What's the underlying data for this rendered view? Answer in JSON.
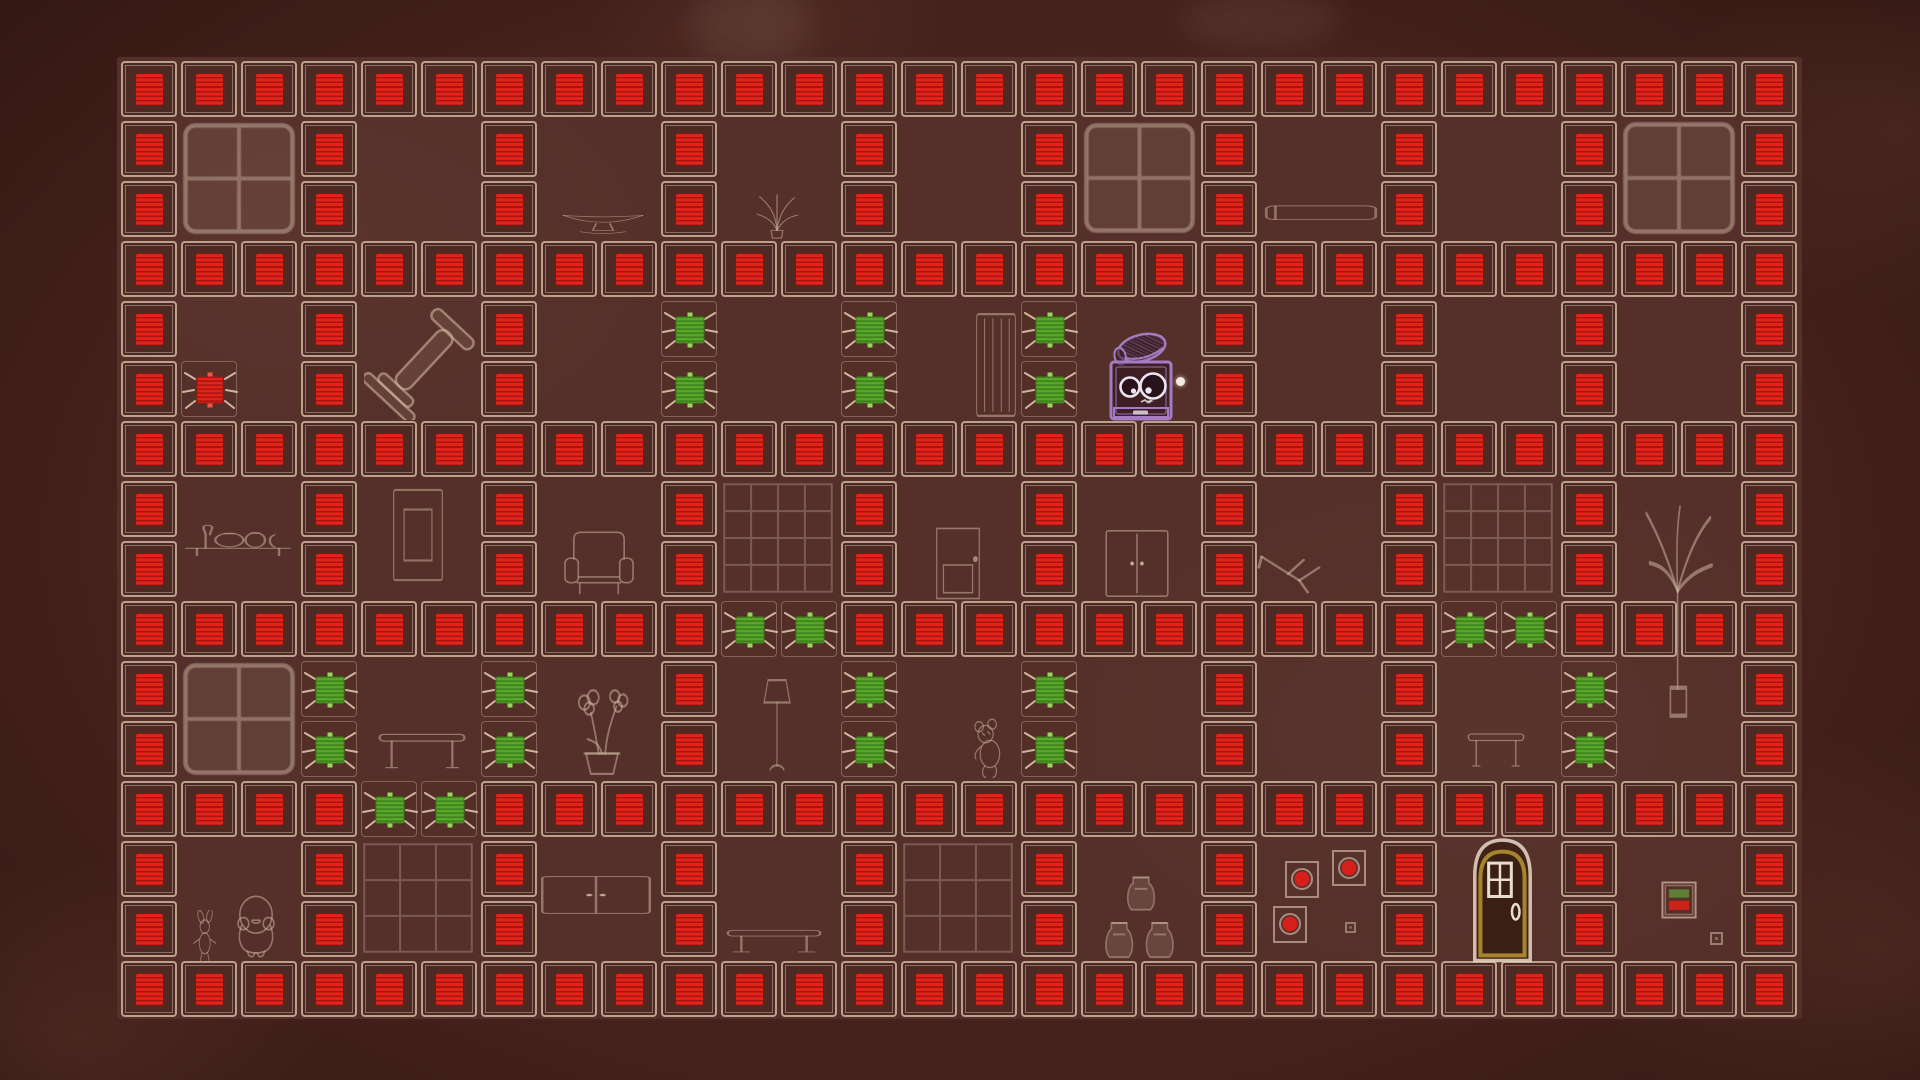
{
  "screen": {
    "type": "puzzle-game-level",
    "visible_text": "",
    "hud": "none"
  },
  "colors": {
    "background": "#45221c",
    "field": "#55302a",
    "tile_outline": "#d9c3ab",
    "wall_fill": "#4c2a23",
    "red_block": "#e2231a",
    "red_block_stripe": "#a81410",
    "gem_green": "#58a827",
    "gem_green_stripe": "#3c7d1a",
    "gem_notch": "#97d55f",
    "whisker": "#dcc5ab",
    "sketch_line": "#cbb39d",
    "player_purple": "#a57cc4",
    "eye_white": "#ece4f0",
    "exit_door_gold": "#a5842e",
    "picture_dot_red": "#d61f1a",
    "cursor_dot": "#f3ece4"
  },
  "level": {
    "cols": 28,
    "rows": 16,
    "cell_px": 60,
    "tile_px": 56,
    "origin_x": 121,
    "origin_y": 61,
    "legend": {
      "W": "red-wall-block",
      "G": "green-gem",
      "R": "red-gem",
      "P": "player",
      ".": "floor"
    },
    "counts": {
      "red_wall_blocks": 246,
      "green_gems": 22,
      "red_gems": 1
    },
    "map": [
      "WWWWWWWWWWWWWWWWWWWWWWWWWWWW",
      "W..W..W..W..W..W..W..W..W..W",
      "W..W..W..W..W..W..W..W..W..W",
      "WWWWWWWWWWWWWWWWWWWWWWWWWWWW",
      "W..W..W..G..G..G..W..W..W..W",
      "WR.W..W..G..G..G.PW..W..W..W",
      "WWWWWWWWWWWWWWWWWWWWWWWWWWWW",
      "W..W..W..W..W..W..W..W..W..W",
      "W..W..W..W..W..W..W..W..W..W",
      "WWWWWWWWWWGGWWWWWWWWWWGGWWWW",
      "W..G..G..W..G..G..W..W..G..W",
      "W..G..G..W..G..G..W..W..G..W",
      "WWWWGGWWWWWWWWWWWWWWWWWWWWWW",
      "W..W..W..W..W..W..W..W..W..W",
      "W..W..W..W..W..W..W..W..W..W",
      "WWWWWWWWWWWWWWWWWWWWWWWWWWWW"
    ]
  },
  "player": {
    "name": "robot",
    "col": 16.5,
    "row": 5,
    "x": 1108,
    "y": 330,
    "w": 66,
    "h": 92,
    "wearing": "knit-cap",
    "dot": {
      "x": 1180,
      "y": 381,
      "r": 4.5
    }
  },
  "furniture": [
    {
      "type": "window",
      "name": "window-sketch",
      "x": 182,
      "y": 122,
      "w": 114,
      "h": 113
    },
    {
      "type": "window",
      "name": "window-sketch",
      "x": 1083,
      "y": 122,
      "w": 113,
      "h": 112
    },
    {
      "type": "window",
      "name": "window-sketch",
      "x": 1622,
      "y": 121,
      "w": 114,
      "h": 114
    },
    {
      "type": "window",
      "name": "light-rug-sketch",
      "x": 182,
      "y": 662,
      "w": 114,
      "h": 114
    },
    {
      "type": "rug4",
      "name": "grid-rug-sketch",
      "x": 722,
      "y": 482,
      "w": 112,
      "h": 112
    },
    {
      "type": "rug4",
      "name": "grid-rug-sketch",
      "x": 1442,
      "y": 482,
      "w": 112,
      "h": 112
    },
    {
      "type": "rug3",
      "name": "grid-rug-sketch",
      "x": 362,
      "y": 842,
      "w": 112,
      "h": 112
    },
    {
      "type": "rug3",
      "name": "grid-rug-sketch",
      "x": 902,
      "y": 842,
      "w": 112,
      "h": 112
    },
    {
      "type": "bowl",
      "name": "bowl-sketch",
      "x": 560,
      "y": 208,
      "w": 86,
      "h": 34
    },
    {
      "type": "agave",
      "name": "spiky-plant-sketch",
      "x": 748,
      "y": 192,
      "w": 58,
      "h": 48
    },
    {
      "type": "sideboard",
      "name": "sideboard-sketch",
      "x": 1264,
      "y": 196,
      "w": 114,
      "h": 38
    },
    {
      "type": "dumbbell",
      "name": "dumbbell-sketch",
      "x": 364,
      "y": 306,
      "w": 114,
      "h": 114
    },
    {
      "type": "slatdoor",
      "name": "slatted-door-sketch",
      "x": 974,
      "y": 312,
      "w": 44,
      "h": 106
    },
    {
      "type": "shelfbottles",
      "name": "shelf-bottles-sketch",
      "x": 184,
      "y": 514,
      "w": 108,
      "h": 52
    },
    {
      "type": "frame2",
      "name": "picture-frame-sketch",
      "x": 389,
      "y": 486,
      "w": 58,
      "h": 98
    },
    {
      "type": "armchair",
      "name": "armchair-sketch",
      "x": 562,
      "y": 528,
      "w": 74,
      "h": 72
    },
    {
      "type": "door1",
      "name": "door-sketch",
      "x": 930,
      "y": 527,
      "w": 56,
      "h": 73
    },
    {
      "type": "wardrobe",
      "name": "wardrobe-sketch",
      "x": 1102,
      "y": 528,
      "w": 70,
      "h": 71
    },
    {
      "type": "chairfallen",
      "name": "tipped-chair-sketch",
      "x": 1256,
      "y": 547,
      "w": 70,
      "h": 54
    },
    {
      "type": "orchid",
      "name": "orchid-pot-sketch",
      "x": 562,
      "y": 676,
      "w": 80,
      "h": 102
    },
    {
      "type": "lamp",
      "name": "floor-lamp-sketch",
      "x": 752,
      "y": 676,
      "w": 50,
      "h": 102
    },
    {
      "type": "teddy",
      "name": "teddy-bear-sketch",
      "x": 964,
      "y": 718,
      "w": 54,
      "h": 62
    },
    {
      "type": "tableS",
      "name": "table-sketch",
      "x": 376,
      "y": 726,
      "w": 92,
      "h": 52
    },
    {
      "type": "tableS",
      "name": "small-table-sketch",
      "x": 1466,
      "y": 726,
      "w": 60,
      "h": 50
    },
    {
      "type": "bigplant",
      "name": "tall-plant-sketch",
      "x": 1640,
      "y": 505,
      "w": 80,
      "h": 215
    },
    {
      "type": "cabinet",
      "name": "cabinet-sketch",
      "x": 540,
      "y": 872,
      "w": 112,
      "h": 46
    },
    {
      "type": "vases",
      "name": "stacked-vases-sketch",
      "x": 1102,
      "y": 866,
      "w": 78,
      "h": 95
    },
    {
      "type": "framesred",
      "name": "framed-gem-pictures",
      "x": 1268,
      "y": 845,
      "w": 100,
      "h": 105
    },
    {
      "type": "exitdoor",
      "name": "exit-door",
      "x": 1471,
      "y": 835,
      "w": 63,
      "h": 128
    },
    {
      "type": "switch",
      "name": "indicator-panel",
      "x": 1661,
      "y": 881,
      "w": 36,
      "h": 38
    },
    {
      "type": "tinysq",
      "name": "tiny-square-mark",
      "x": 1345,
      "y": 922,
      "w": 11,
      "h": 11
    },
    {
      "type": "tinysq",
      "name": "tiny-square-mark",
      "x": 1710,
      "y": 932,
      "w": 13,
      "h": 13
    },
    {
      "type": "bench",
      "name": "bench-sketch",
      "x": 726,
      "y": 926,
      "w": 96,
      "h": 36
    },
    {
      "type": "bunny",
      "name": "bunny-doll-sketch",
      "x": 190,
      "y": 910,
      "w": 36,
      "h": 52
    },
    {
      "type": "bird",
      "name": "bird-doll-sketch",
      "x": 226,
      "y": 893,
      "w": 60,
      "h": 68
    }
  ]
}
